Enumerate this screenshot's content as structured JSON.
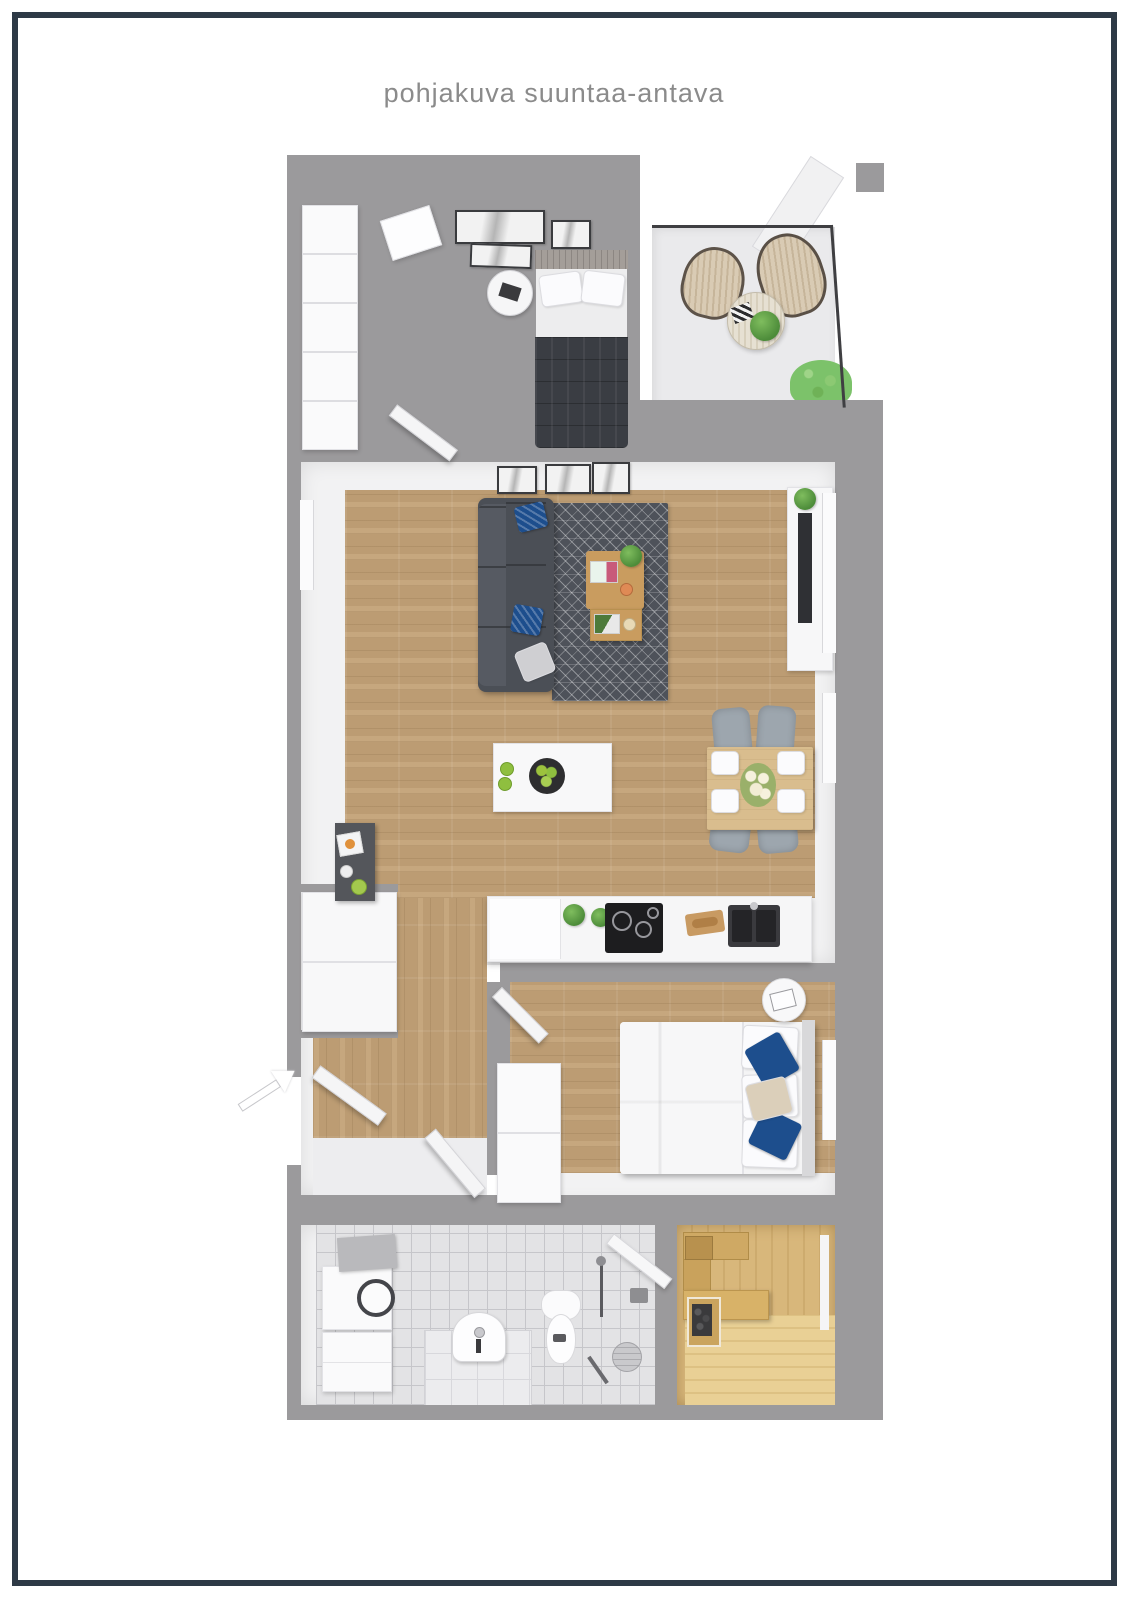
{
  "title": {
    "text": "pohjakuva suuntaa-antava",
    "color": "#8b8b8b"
  },
  "frame": {
    "color": "#2e3a46",
    "inset_px": 12,
    "thickness_px": 6
  },
  "palette": {
    "background": "#ffffff",
    "wall_gray": "#9b9a9c",
    "wall_white": "#f2f2f3",
    "floor_wood": "#c3a277",
    "balcony_floor": "#eaeaec",
    "tile_floor": "#e3e3e5",
    "sauna_wood": "#d8b77b",
    "sofa_gray": "#4b4f56",
    "rug_gray": "#4e525a",
    "bed_dark": "#3a3d43",
    "accent_blue": "#1d4e8d",
    "plant_green": "#5fa24a",
    "table_oak": "#c99c5f",
    "dining_wood": "#d9bd8e"
  },
  "floorplan": {
    "rooms": [
      {
        "id": "bedroom-top",
        "floor": "wood",
        "furniture": [
          "wardrobe",
          "dark-double-bed",
          "round-side-table",
          "art-frames",
          "skylight-window",
          "open-door"
        ]
      },
      {
        "id": "balcony",
        "floor": "concrete",
        "furniture": [
          "rattan-chair",
          "rattan-chair",
          "round-table-with-plant",
          "shrub",
          "railing",
          "corner-wall"
        ]
      },
      {
        "id": "living-room",
        "floor": "wood",
        "furniture": [
          "sofa",
          "area-rug",
          "coffee-table",
          "nesting-table",
          "tv-console",
          "tv",
          "art-frames",
          "windows"
        ]
      },
      {
        "id": "kitchen",
        "floor": "wood",
        "furniture": [
          "island-with-fruit-bowl",
          "counter-run",
          "tall-cabinet",
          "cooktop",
          "sink",
          "cutting-board",
          "herb-plants"
        ]
      },
      {
        "id": "dining-area",
        "floor": "wood",
        "furniture": [
          "dining-table",
          "four-chairs",
          "place-settings",
          "flower-centerpiece"
        ]
      },
      {
        "id": "hallway",
        "floor": "wood",
        "furniture": [
          "dark-console",
          "closet-cabinet",
          "entrance-door-open",
          "bathroom-door-open",
          "entrance-arrow"
        ]
      },
      {
        "id": "bedroom-main",
        "floor": "wood",
        "furniture": [
          "white-double-bed",
          "blue-accent-pillows",
          "dresser",
          "round-bedside-table",
          "open-door",
          "window"
        ]
      },
      {
        "id": "bathroom",
        "floor": "tile",
        "furniture": [
          "washer-dryer-stack",
          "pedestal-sink",
          "toilet",
          "shower-rail",
          "glass-panel",
          "stool",
          "squeegee"
        ]
      },
      {
        "id": "sauna",
        "floor": "pine-wood",
        "furniture": [
          "benches",
          "heater-with-stones",
          "door-glass-slit"
        ]
      }
    ]
  }
}
